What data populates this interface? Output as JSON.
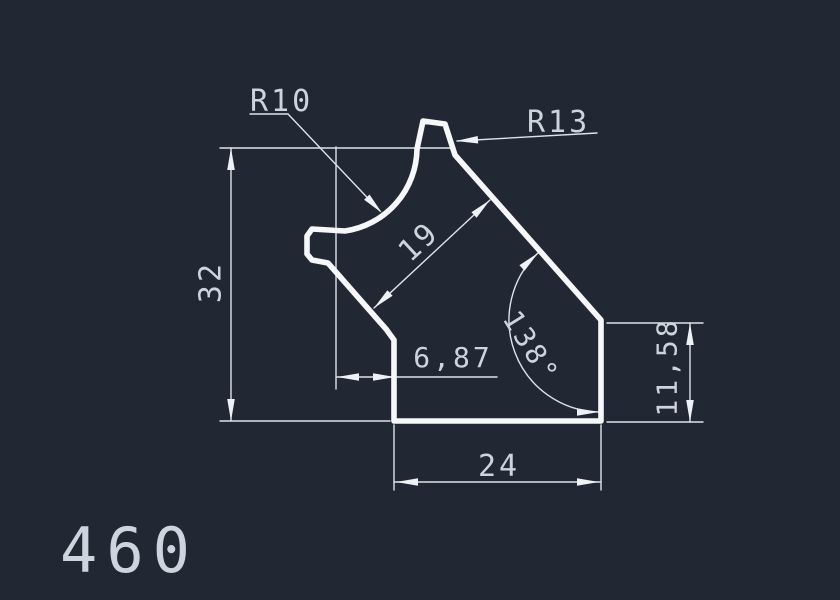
{
  "drawing": {
    "profile_number": "460",
    "background_color": "#212833",
    "line_color": "#dde3ea",
    "profile_color": "#f5f7f9",
    "dimensions": {
      "radius_small_label": "R10",
      "radius_large_label": "R13",
      "overall_height": "32",
      "wall_thickness": "19",
      "offset_width": "6,87",
      "angle": "138°",
      "right_height": "11,58",
      "bottom_width": "24"
    }
  }
}
